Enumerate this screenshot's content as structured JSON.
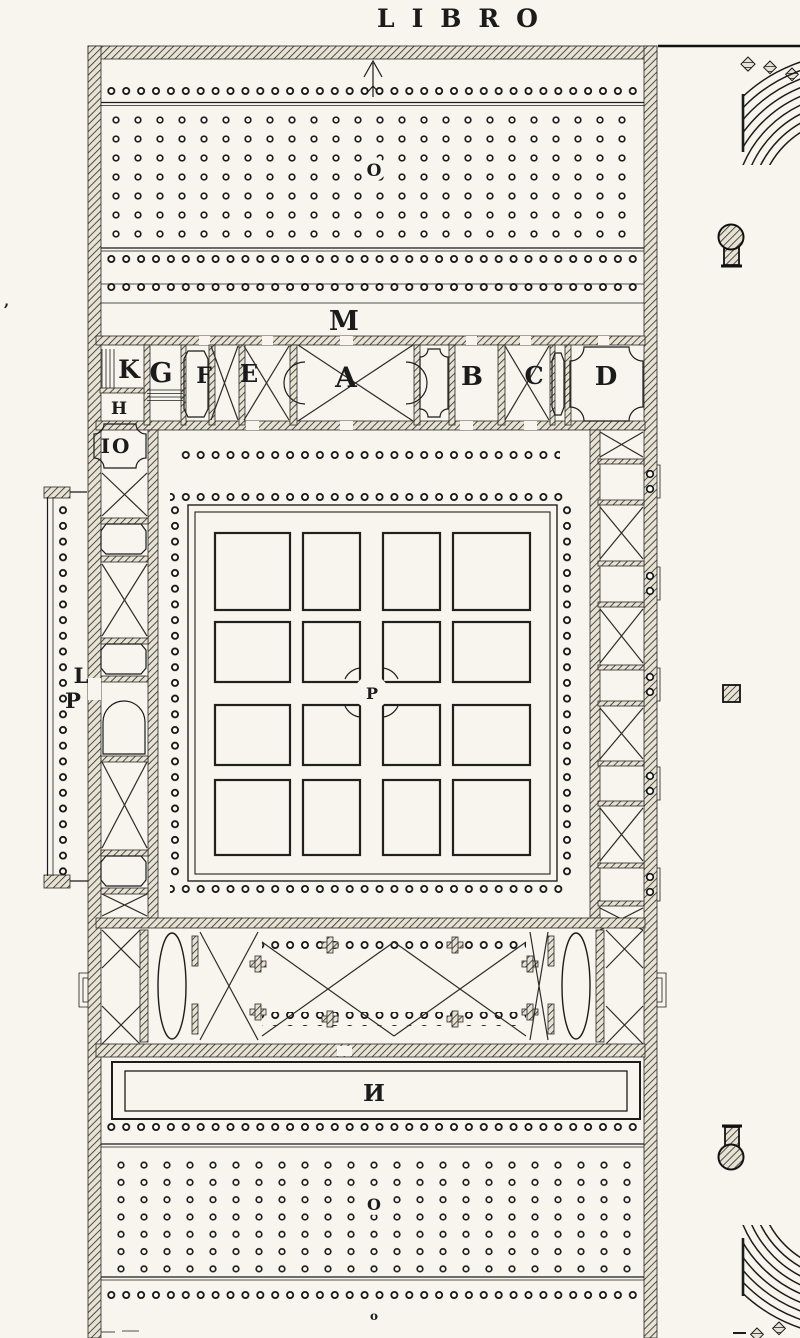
{
  "page": {
    "title": "LIBRO",
    "paper_color": "#f7f5ee",
    "ink_color": "#1c1c1c"
  },
  "plan": {
    "labels": {
      "M": "M",
      "K": "K",
      "G": "G",
      "F": "F",
      "E": "E",
      "A": "A",
      "B": "B",
      "C": "C",
      "D": "D",
      "H": "H",
      "IO": "IO",
      "L": "L",
      "P_portico": "P",
      "P_garden": "P",
      "N": "И",
      "O_top_grove": "O",
      "O_bottom_grove": "O",
      "o_bottom_edge": "o",
      "comma_left_margin": ","
    }
  }
}
